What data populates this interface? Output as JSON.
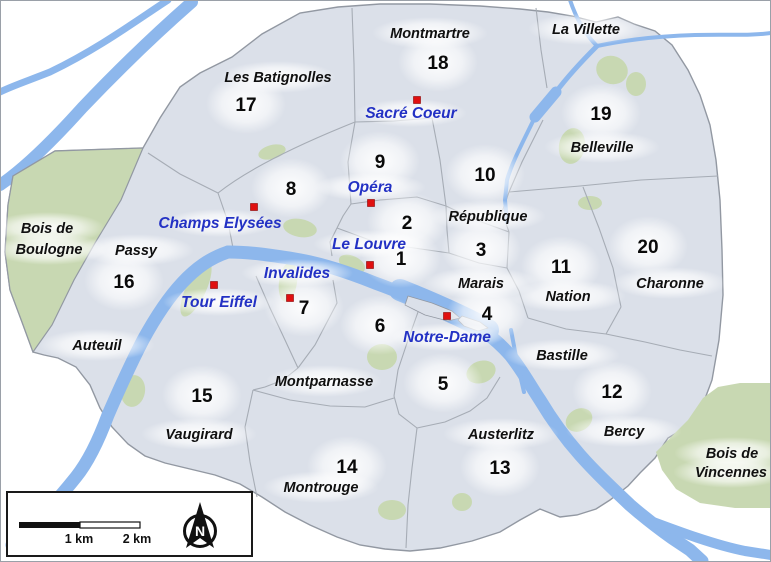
{
  "map": {
    "description": "Paris arrondissements map",
    "colors": {
      "background": "#ffffff",
      "city_fill": "#dbe0e9",
      "city_border": "#9298a2",
      "district_border": "#a6acb5",
      "park_green": "#c8d8b2",
      "river_fill": "#8db7ec",
      "river_edge": "#6b97d9",
      "label_black": "#101010",
      "landmark_blue": "#2331c4",
      "marker_red": "#e01010"
    },
    "districts": [
      {
        "num": "1",
        "x": 401,
        "y": 265
      },
      {
        "num": "2",
        "x": 407,
        "y": 229
      },
      {
        "num": "3",
        "x": 481,
        "y": 256
      },
      {
        "num": "4",
        "x": 487,
        "y": 320
      },
      {
        "num": "5",
        "x": 443,
        "y": 390
      },
      {
        "num": "6",
        "x": 380,
        "y": 332
      },
      {
        "num": "7",
        "x": 304,
        "y": 314
      },
      {
        "num": "8",
        "x": 291,
        "y": 195
      },
      {
        "num": "9",
        "x": 380,
        "y": 168
      },
      {
        "num": "10",
        "x": 485,
        "y": 181
      },
      {
        "num": "11",
        "x": 561,
        "y": 273
      },
      {
        "num": "12",
        "x": 612,
        "y": 398
      },
      {
        "num": "13",
        "x": 500,
        "y": 474
      },
      {
        "num": "14",
        "x": 347,
        "y": 473
      },
      {
        "num": "15",
        "x": 202,
        "y": 402
      },
      {
        "num": "16",
        "x": 124,
        "y": 288
      },
      {
        "num": "17",
        "x": 246,
        "y": 111
      },
      {
        "num": "18",
        "x": 438,
        "y": 69
      },
      {
        "num": "19",
        "x": 601,
        "y": 120
      },
      {
        "num": "20",
        "x": 648,
        "y": 253
      }
    ],
    "places": [
      {
        "name": "Montmartre",
        "x": 430,
        "y": 38
      },
      {
        "name": "La Villette",
        "x": 586,
        "y": 34
      },
      {
        "name": "Les Batignolles",
        "x": 278,
        "y": 82
      },
      {
        "name": "Belleville",
        "x": 602,
        "y": 152
      },
      {
        "name": "Bois de",
        "x": 47,
        "y": 233
      },
      {
        "name": "Boulogne",
        "x": 49,
        "y": 254
      },
      {
        "name": "Passy",
        "x": 136,
        "y": 255
      },
      {
        "name": "République",
        "x": 488,
        "y": 221
      },
      {
        "name": "Marais",
        "x": 481,
        "y": 288
      },
      {
        "name": "Nation",
        "x": 568,
        "y": 301
      },
      {
        "name": "Charonne",
        "x": 670,
        "y": 288
      },
      {
        "name": "Auteuil",
        "x": 97,
        "y": 350
      },
      {
        "name": "Montparnasse",
        "x": 324,
        "y": 386
      },
      {
        "name": "Bastille",
        "x": 562,
        "y": 360
      },
      {
        "name": "Vaugirard",
        "x": 199,
        "y": 439
      },
      {
        "name": "Austerlitz",
        "x": 501,
        "y": 439
      },
      {
        "name": "Bercy",
        "x": 624,
        "y": 436
      },
      {
        "name": "Montrouge",
        "x": 321,
        "y": 492
      },
      {
        "name": "Bois de",
        "x": 732,
        "y": 458
      },
      {
        "name": "Vincennes",
        "x": 731,
        "y": 477
      }
    ],
    "landmarks": [
      {
        "name": "Sacré Coeur",
        "marker": [
          417,
          100
        ],
        "label": [
          411,
          118
        ]
      },
      {
        "name": "Opéra",
        "marker": [
          371,
          203
        ],
        "label": [
          370,
          192
        ]
      },
      {
        "name": "Champs Elysées",
        "marker": [
          254,
          207
        ],
        "label": [
          220,
          228
        ]
      },
      {
        "name": "Le Louvre",
        "marker": [
          370,
          265
        ],
        "label": [
          369,
          249
        ]
      },
      {
        "name": "Invalides",
        "marker": [
          290,
          298
        ],
        "label": [
          297,
          278
        ]
      },
      {
        "name": "Tour Eiffel",
        "marker": [
          214,
          285
        ],
        "label": [
          219,
          307
        ]
      },
      {
        "name": "Notre-Dame",
        "marker": [
          447,
          316
        ],
        "label": [
          447,
          342
        ]
      }
    ],
    "scale_bar": {
      "label_1km": "1 km",
      "label_2km": "2 km"
    },
    "compass": {
      "north_label": "N"
    }
  }
}
